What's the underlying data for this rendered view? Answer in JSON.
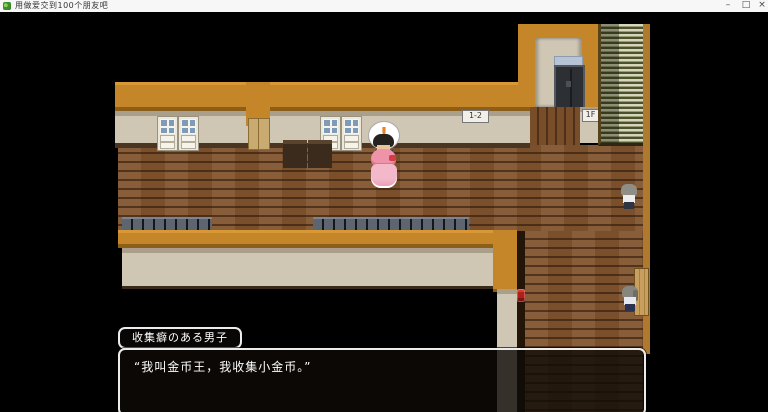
{
  "titlebar": {
    "title": "用做爱交到100个朋友吧",
    "minimize_glyph": "–",
    "maximize_glyph": "□",
    "close_glyph": "×"
  },
  "scene": {
    "signs": {
      "room_number": "1-2",
      "floor": "1F"
    },
    "balloon_symbol": "!",
    "colors": {
      "roof_orange": "#c5862a",
      "wall_beige": "#cfc6b4",
      "floor_wood": "#82552f",
      "stairs_light": "#d8d5bd",
      "stairs_dark": "#4b502d",
      "exclamation_orange": "#e5822a"
    }
  },
  "dialogue": {
    "speaker": "收集癖のある男子",
    "text": "“我叫金币王，我收集小金币。”"
  }
}
